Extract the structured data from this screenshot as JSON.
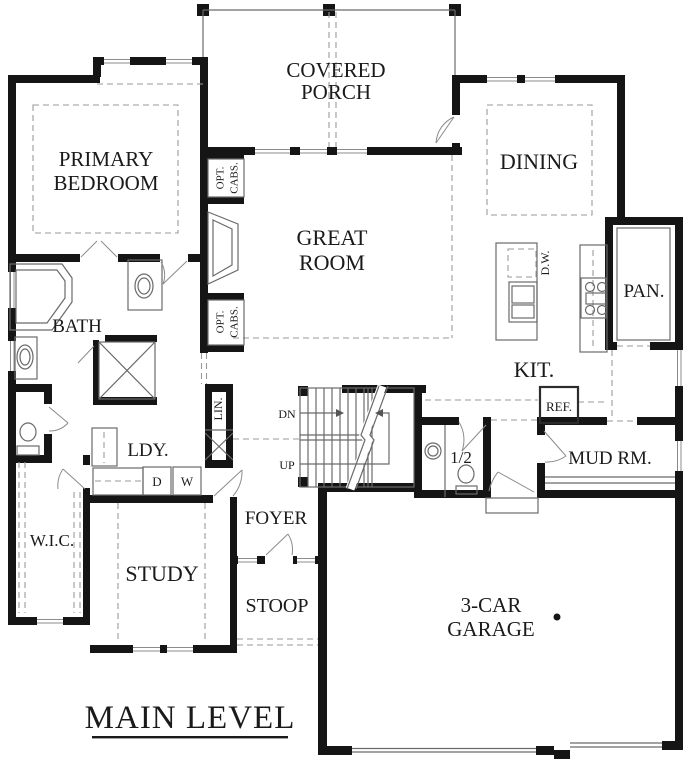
{
  "title": {
    "text": "MAIN LEVEL"
  },
  "rooms": {
    "covered_porch": {
      "line1": "COVERED",
      "line2": "PORCH"
    },
    "primary_bedroom": {
      "line1": "PRIMARY",
      "line2": "BEDROOM"
    },
    "dining": {
      "label": "DINING"
    },
    "great_room": {
      "line1": "GREAT",
      "line2": "ROOM"
    },
    "bath": {
      "label": "BATH"
    },
    "kitchen": {
      "label": "KIT."
    },
    "pantry": {
      "label": "PAN."
    },
    "laundry": {
      "label": "LDY."
    },
    "linen": {
      "label": "LIN."
    },
    "wic": {
      "label": "W.I.C."
    },
    "study": {
      "label": "STUDY"
    },
    "foyer": {
      "label": "FOYER"
    },
    "stoop": {
      "label": "STOOP"
    },
    "half_bath": {
      "label": "1/2"
    },
    "mud_room": {
      "label": "MUD RM."
    },
    "garage": {
      "line1": "3-CAR",
      "line2": "GARAGE"
    }
  },
  "fixtures": {
    "dishwasher": "D.W.",
    "refrigerator": "REF.",
    "dryer": "D",
    "washer": "W",
    "stairs_down": "DN",
    "stairs_up": "UP",
    "opt_cabs_upper": {
      "line1": "OPT.",
      "line2": "CABS."
    },
    "opt_cabs_lower": {
      "line1": "OPT.",
      "line2": "CABS."
    }
  },
  "colors": {
    "wall": "#151515",
    "line": "#6a6a6a",
    "dash": "#9a9a9a",
    "background": "#ffffff"
  }
}
